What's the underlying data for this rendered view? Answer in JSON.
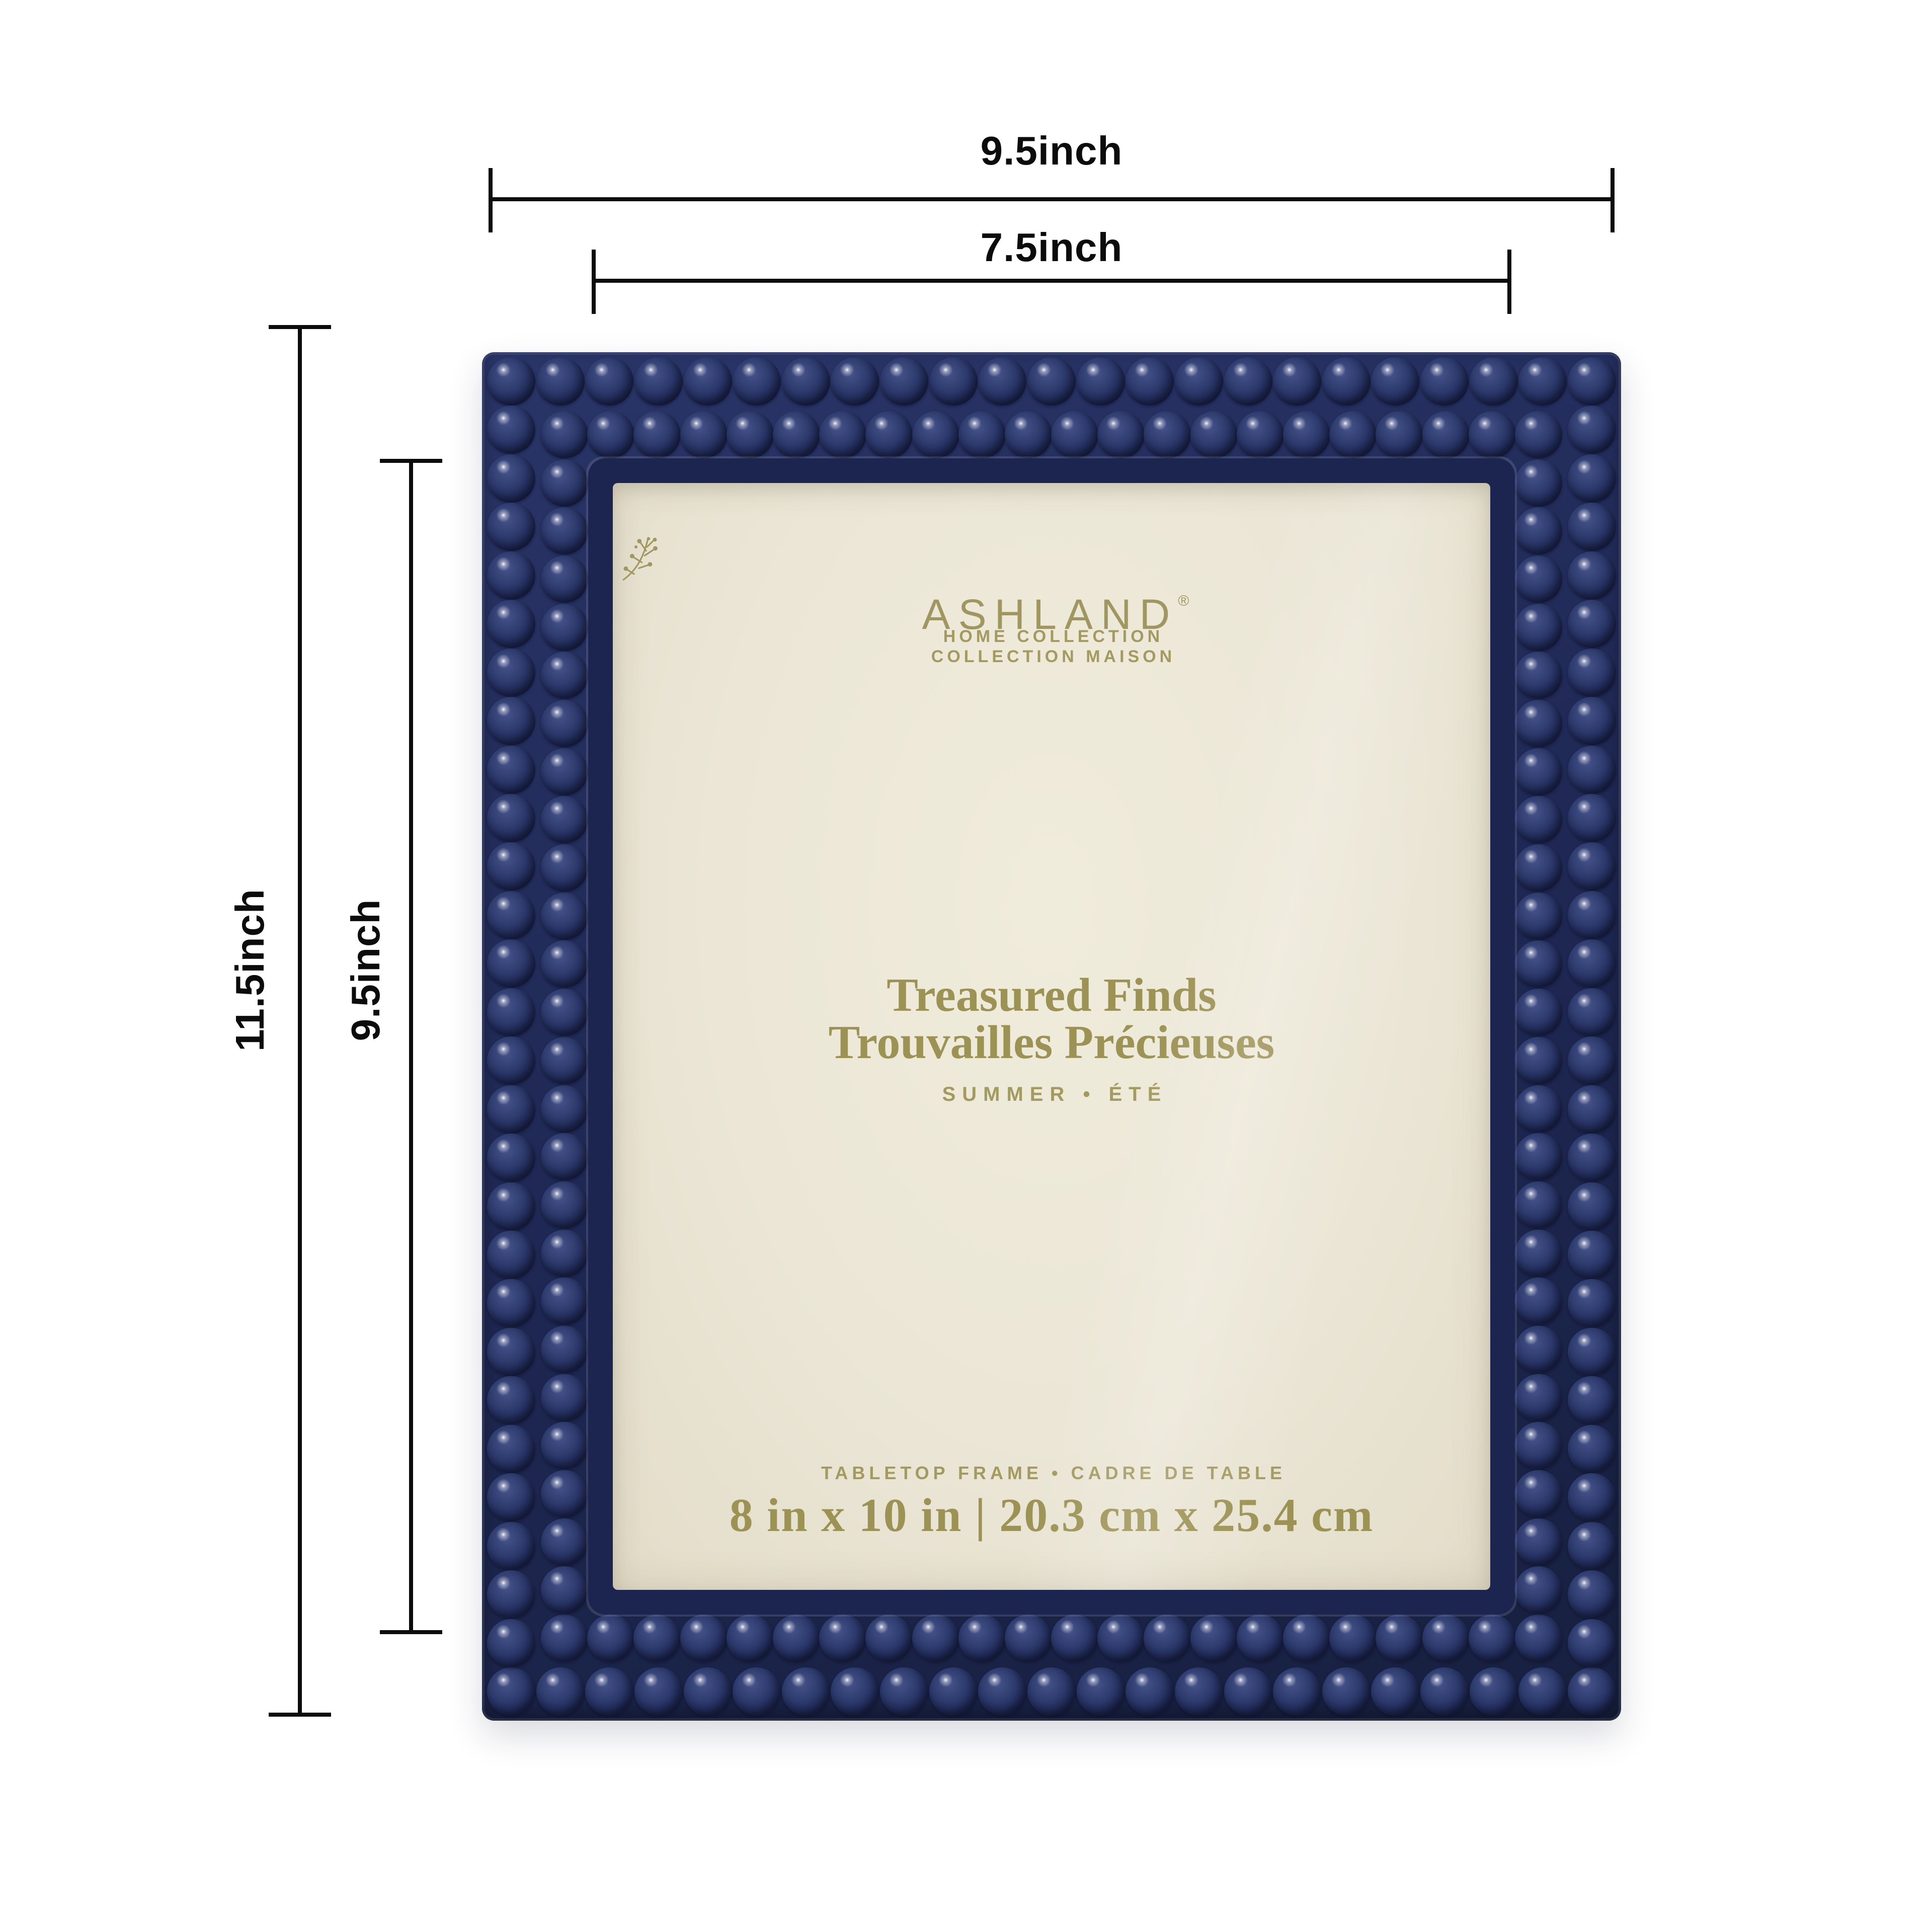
{
  "dimensions": {
    "outer_width_label": "9.5inch",
    "inner_width_label": "7.5inch",
    "outer_height_label": "11.5inch",
    "inner_height_label": "9.5inch"
  },
  "card": {
    "brand": "ASHLAND",
    "registered": "®",
    "collection_en": "HOME COLLECTION",
    "collection_fr": "COLLECTION MAISON",
    "title_en": "Treasured Finds",
    "title_fr": "Trouvailles Précieuses",
    "season": "SUMMER • ÉTÉ",
    "type_line": "TABLETOP FRAME • CADRE DE TABLE",
    "size_line": "8 in x 10 in | 20.3 cm x 25.4 cm"
  },
  "colors": {
    "frame_navy": "#1e2752",
    "bead_mid": "#2d3a6d",
    "card_cream": "#ebe6d6",
    "text_olive": "#9c9254",
    "dimension_black": "#0c0c0c",
    "background": "#ffffff"
  },
  "icons": {
    "sprig": "berry-branch"
  }
}
